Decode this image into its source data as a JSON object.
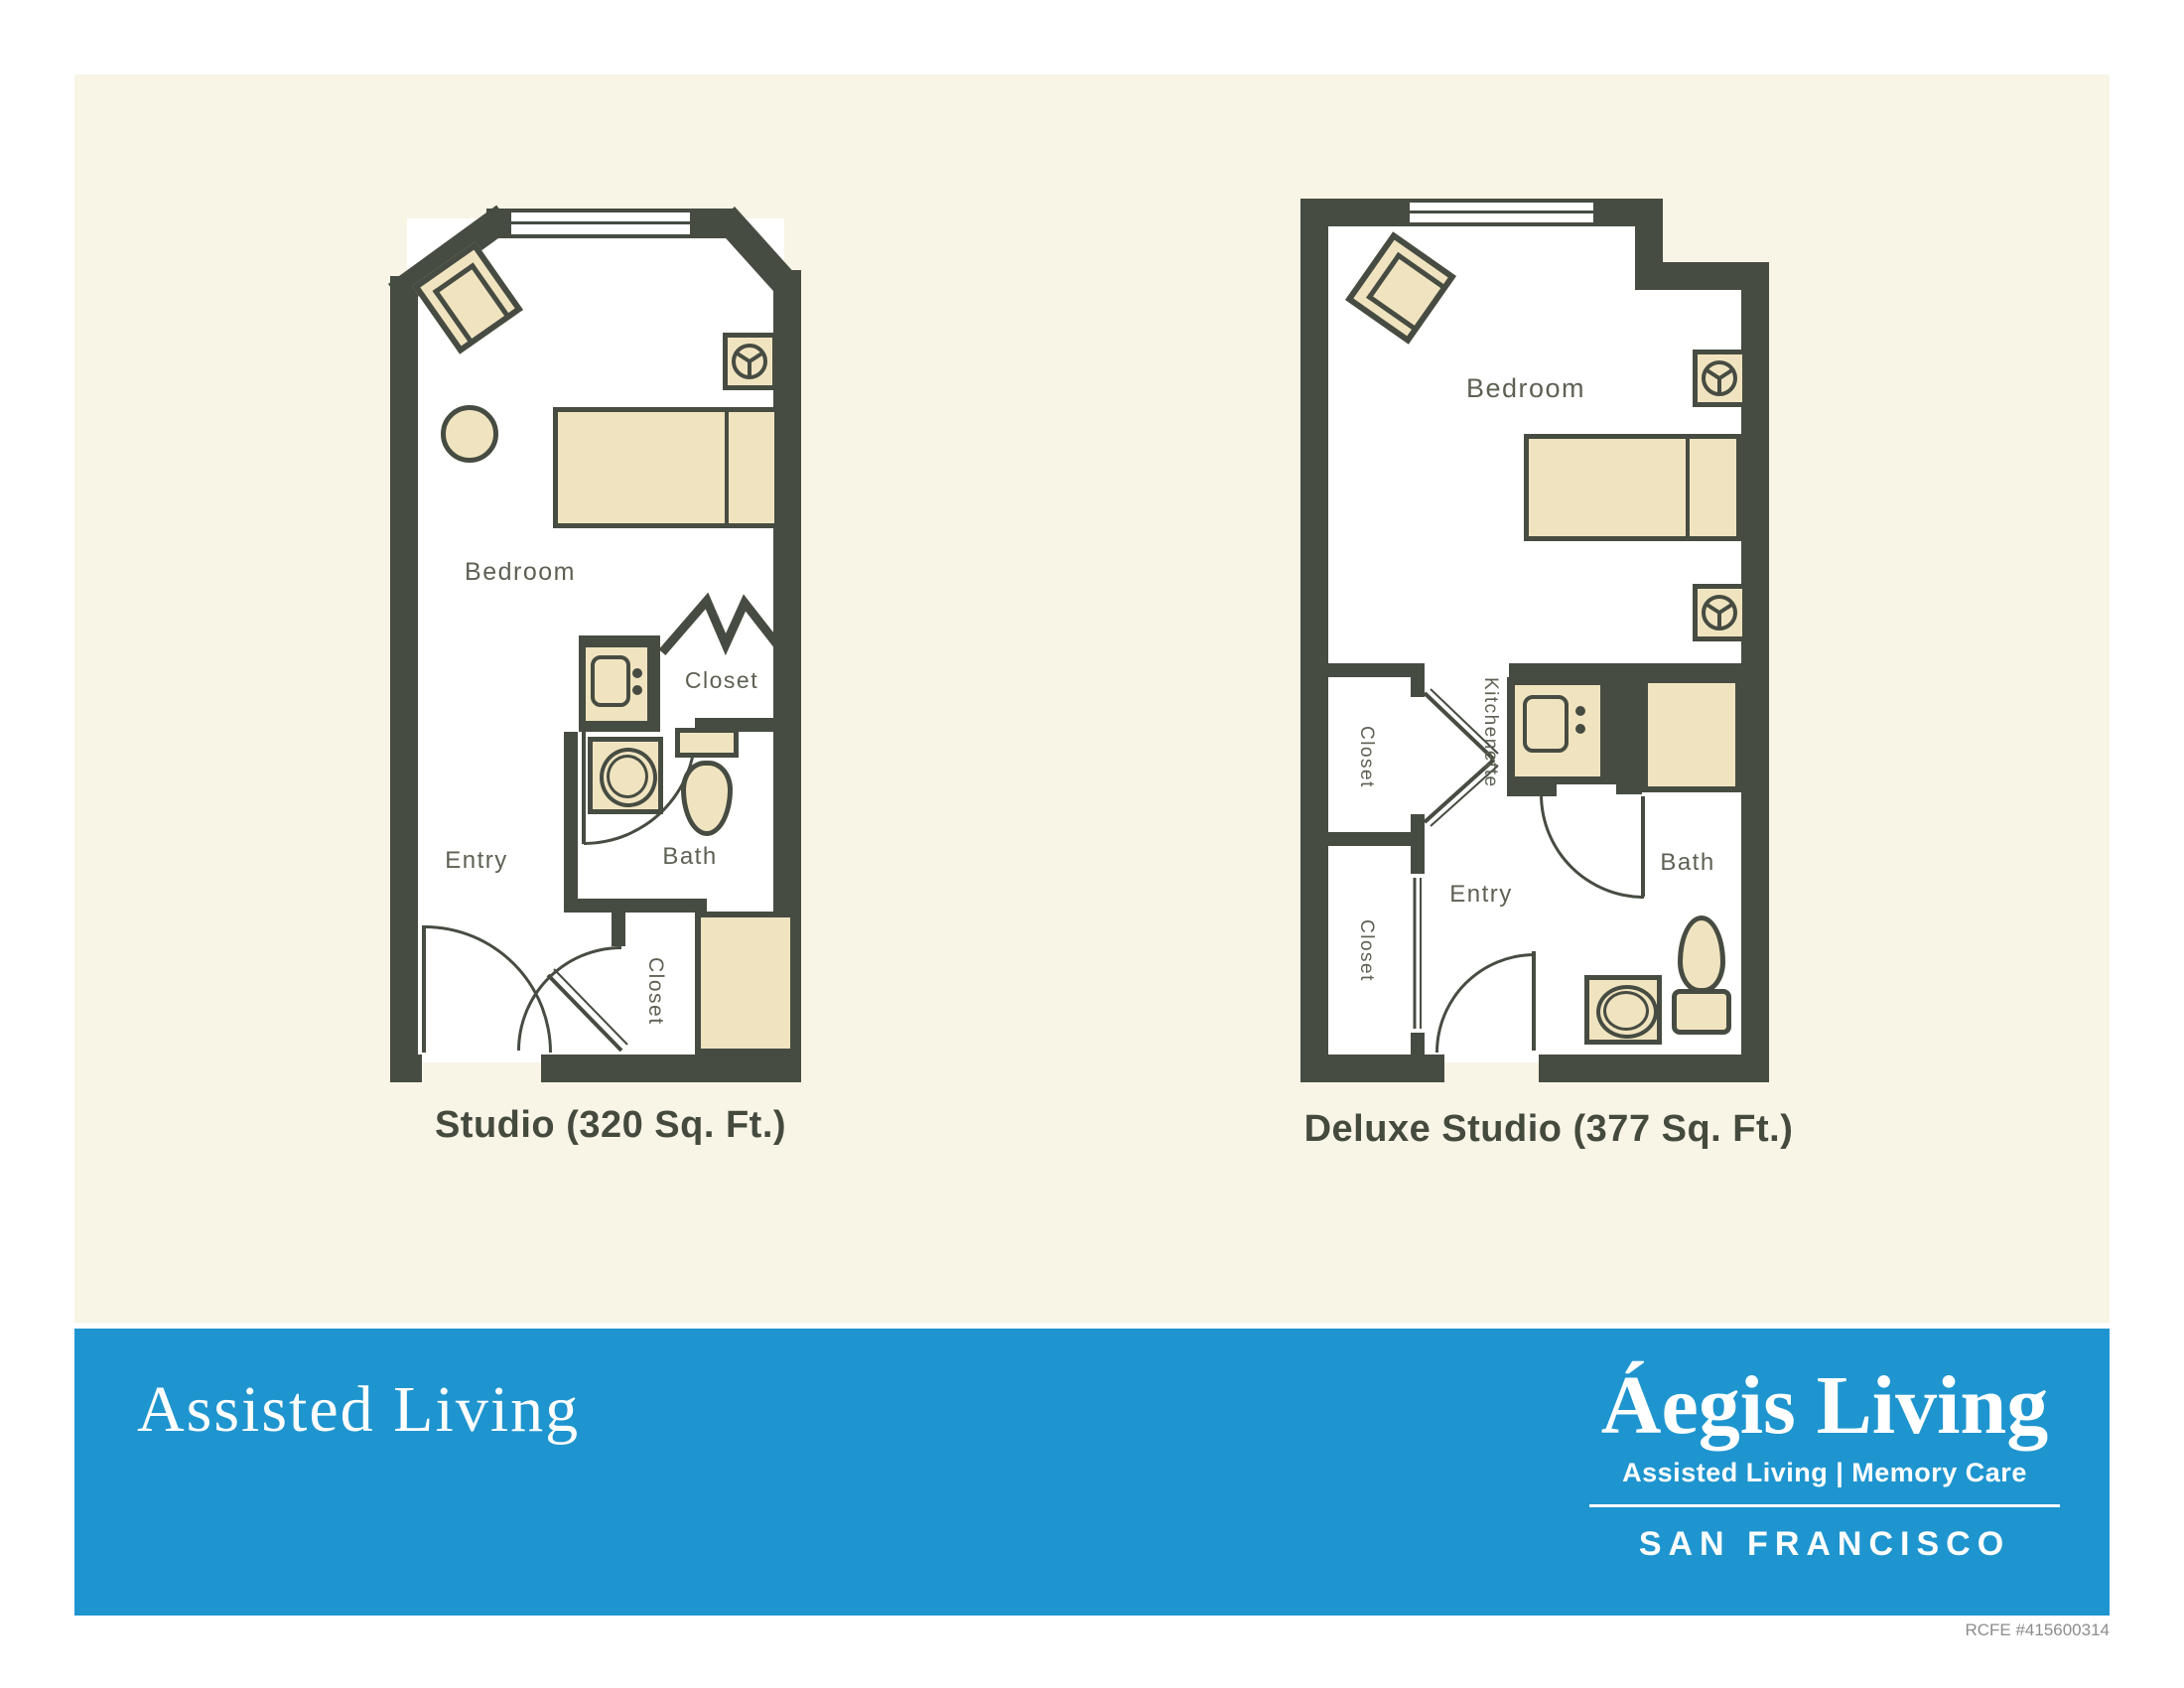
{
  "colors": {
    "wall": "#474c42",
    "furniture_fill": "#f0e4c0",
    "cream_background": "#f8f5e6",
    "banner_blue": "#1f95cf",
    "label_text": "#5c6153",
    "caption_text": "#454a3e",
    "footnote_gray": "#8c8c8c"
  },
  "plans": {
    "studio": {
      "caption": "Studio (320 Sq. Ft.)",
      "labels": {
        "bedroom": "Bedroom",
        "closet_upper": "Closet",
        "bath": "Bath",
        "entry": "Entry",
        "closet_lower": "Closet"
      }
    },
    "deluxe": {
      "caption": "Deluxe Studio (377 Sq. Ft.)",
      "labels": {
        "bedroom": "Bedroom",
        "kitchenette": "Kitchenette",
        "closet_upper": "Closet",
        "closet_lower": "Closet",
        "entry": "Entry",
        "bath": "Bath"
      }
    }
  },
  "banner": {
    "headline": "Assisted Living",
    "brand": "Áegis Living",
    "tagline": "Assisted Living | Memory Care",
    "location": "SAN FRANCISCO"
  },
  "footnote": "RCFE #415600314"
}
